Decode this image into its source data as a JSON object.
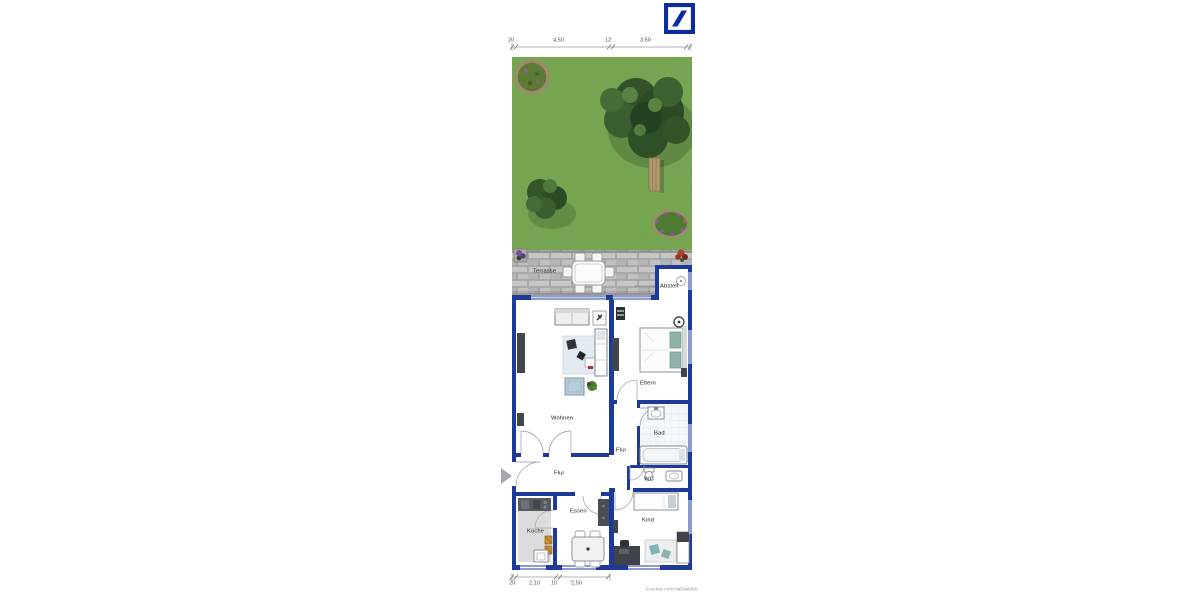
{
  "brand": {
    "logo_icon": "deutsche-bank-slash-logo"
  },
  "dim_top": [
    "20",
    "4,50",
    "12",
    "3,50"
  ],
  "dim_bottom": [
    "20",
    "2,10",
    "10",
    "2,50"
  ],
  "rooms": {
    "terrasse": "Terrasse",
    "abstell": "Abstell",
    "wohnen": "Wohnen",
    "eltern": "Eltern",
    "flur_right": "Flur",
    "bad": "Bad",
    "wc": "WC",
    "flur_left": "Flur",
    "kueche": "Küche",
    "essen": "Essen",
    "kind": "Kind"
  },
  "footnote": "Grundriss nicht maßstäblich",
  "colors": {
    "wall": "#1d3a9b",
    "logo": "#0b2da0",
    "grass": "#74a450",
    "terrace_paver": "#bdbdbd",
    "accent_teal": "#8fb3ac"
  }
}
